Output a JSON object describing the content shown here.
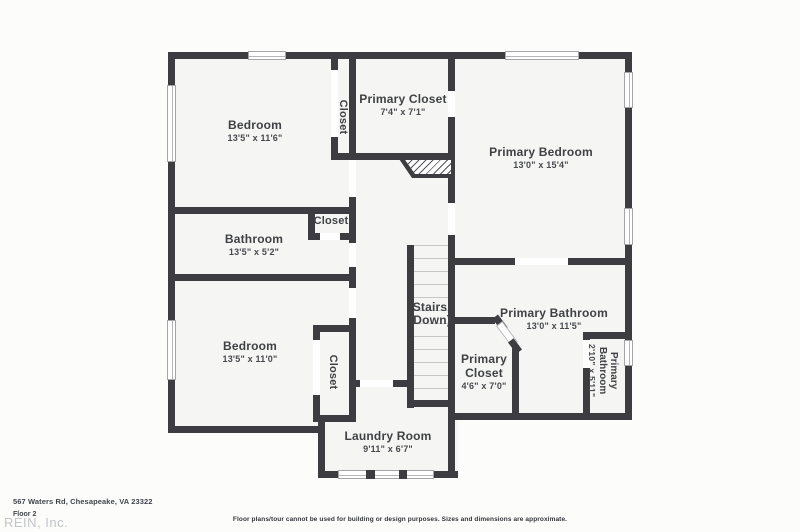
{
  "palette": {
    "wall": "#3d3d41",
    "floor": "#f5f5f3",
    "background": "#fcfcfb",
    "label_text": "#3f4145",
    "watermark_text": "#c2c5c9",
    "window_line": "#a3a5a6",
    "stair_tread_line": "#c7c7c7"
  },
  "rooms": {
    "bedroom1": {
      "name": "Bedroom",
      "dims": "13'5\" x 11'6\""
    },
    "closet_top": {
      "name": "Closet"
    },
    "primary_closet_top": {
      "name": "Primary Closet",
      "dims": "7'4\" x 7'1\""
    },
    "primary_bedroom": {
      "name": "Primary Bedroom",
      "dims": "13'0\" x 15'4\""
    },
    "bathroom": {
      "name": "Bathroom",
      "dims": "13'5\" x 5'2\""
    },
    "closet_bathroom": {
      "name": "Closet"
    },
    "bedroom2": {
      "name": "Bedroom",
      "dims": "13'5\" x 11'0\""
    },
    "closet_bedroom2": {
      "name": "Closet"
    },
    "stairs": {
      "line1": "Stairs",
      "line2": "(Down)"
    },
    "primary_bathroom": {
      "name": "Primary Bathroom",
      "dims": "13'0\" x 11'5\""
    },
    "primary_closet_small": {
      "name": "Primary Closet",
      "dims": "4'6\" x 7'0\""
    },
    "primary_bathroom_small": {
      "name": "Primary Bathroom",
      "dims": "2'10\" x 5'11\""
    },
    "laundry": {
      "name": "Laundry Room",
      "dims": "9'11\" x 6'7\""
    }
  },
  "footer": {
    "address": "567 Waters Rd, Chesapeake, VA 23322",
    "floor": "Floor 2",
    "watermark": "REIN, Inc.",
    "disclaimer": "Floor plans/tour cannot be used for building or design purposes. Sizes and dimensions are approximate."
  }
}
